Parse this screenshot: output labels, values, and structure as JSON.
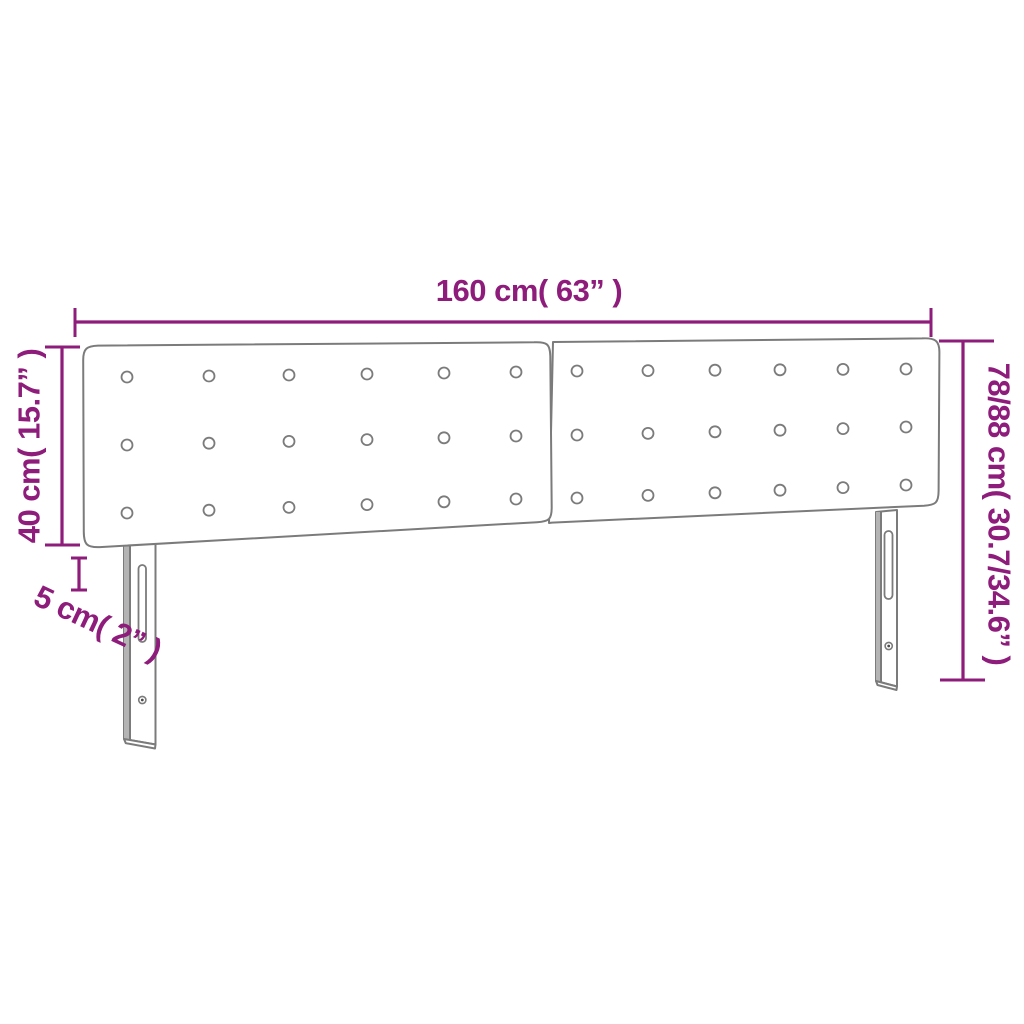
{
  "diagram": {
    "subject": "upholstered-headboard-front-view",
    "labels": {
      "width": "160 cm( 63” )",
      "total_height": "78/88 cm( 30.7/34.6” )",
      "headboard_height": "40 cm( 15.7” )",
      "thickness": "5 cm( 2” )"
    },
    "colors": {
      "dimension_accent": "#8E1C7B",
      "outline_gray": "#7B7B7B",
      "background": "#FFFFFF"
    },
    "drawing": {
      "panels": 2,
      "tuft_button_rows_per_panel": 3,
      "tuft_button_cols_per_panel": 6,
      "legs": 2,
      "slots_per_leg": 1,
      "screws_per_leg": 1
    }
  }
}
